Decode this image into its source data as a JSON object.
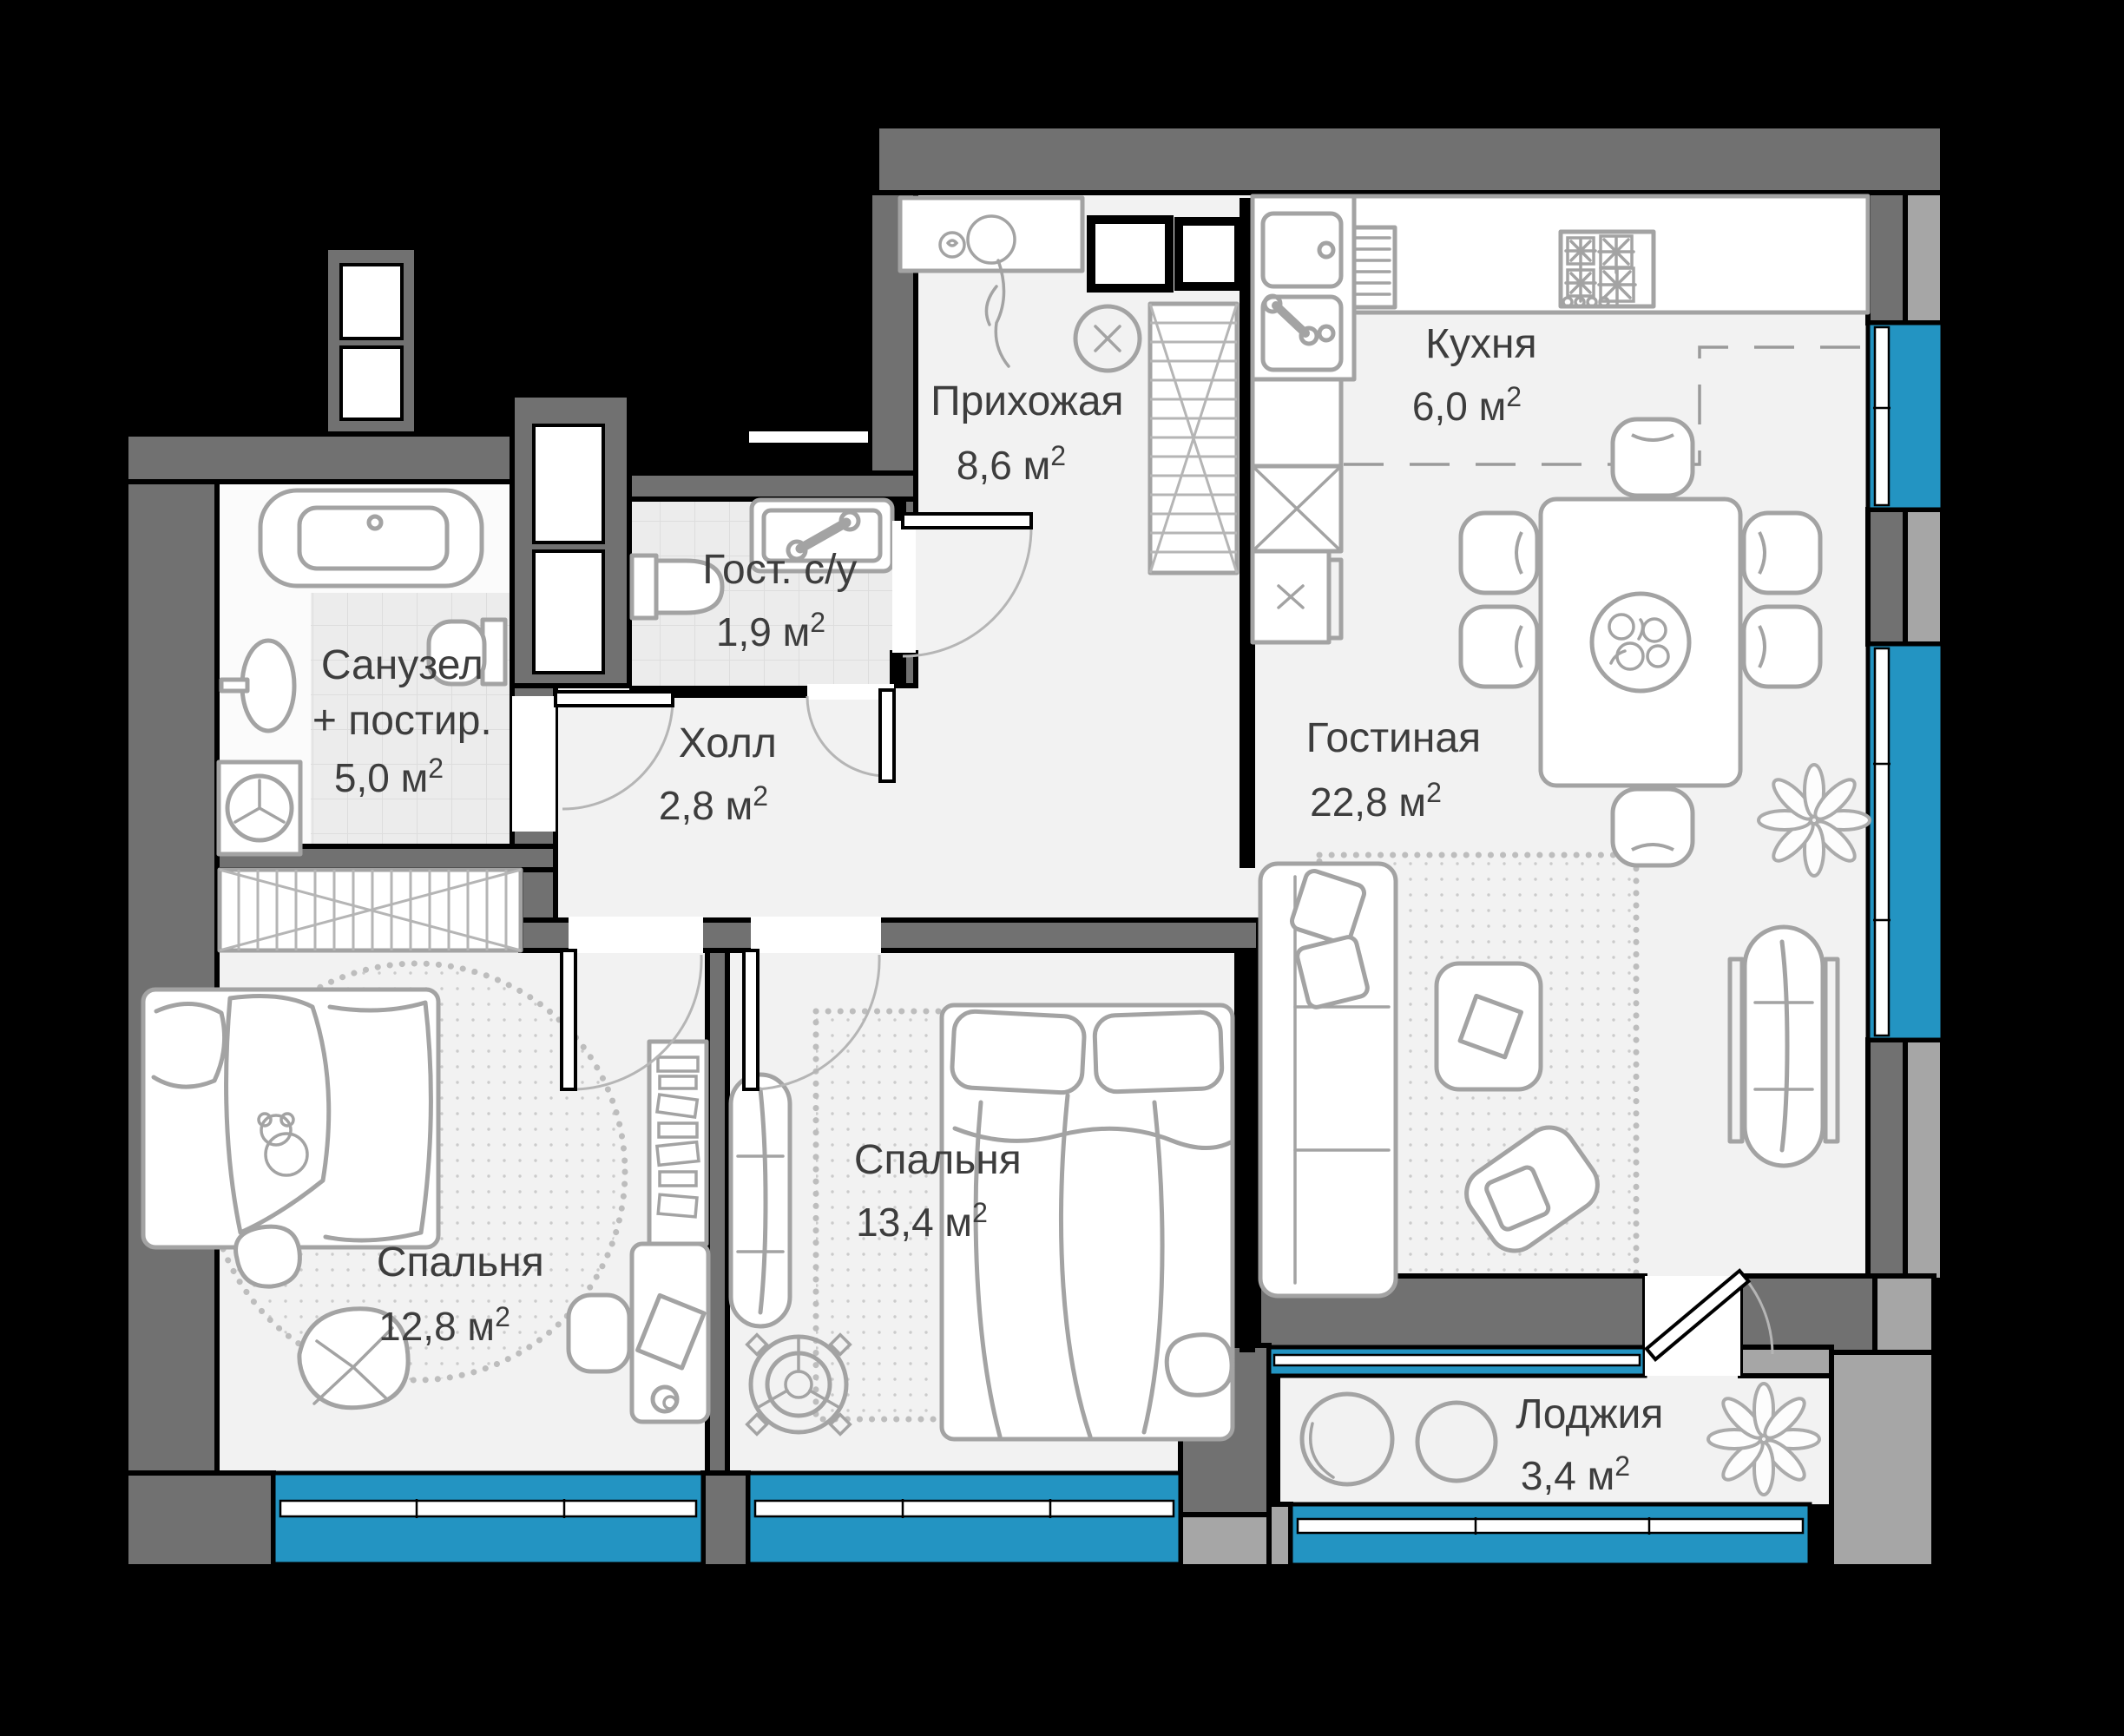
{
  "title": "Floor plan of 2-bedroom apartment",
  "labels": {
    "sup": "2"
  },
  "rooms": [
    {
      "id": "hallway",
      "name": "Прихожая",
      "area": "8,6 м"
    },
    {
      "id": "kitchen",
      "name": "Кухня",
      "area": "6,0 м"
    },
    {
      "id": "guest-wc",
      "name": "Гост. с/у",
      "area": "1,9 м"
    },
    {
      "id": "bathroom",
      "name": "Санузел",
      "name2": "+ постир.",
      "area": "5,0 м"
    },
    {
      "id": "hall",
      "name": "Холл",
      "area": "2,8 м"
    },
    {
      "id": "living-room",
      "name": "Гостиная",
      "area": "22,8 м"
    },
    {
      "id": "bedroom-middle",
      "name": "Спальня",
      "area": "13,4 м"
    },
    {
      "id": "bedroom-left",
      "name": "Спальня",
      "area": "12,8 м"
    },
    {
      "id": "loggia",
      "name": "Лоджия",
      "area": "3,4 м"
    }
  ],
  "colors": {
    "bg": "#000000",
    "wall_dark": "#717171",
    "wall_light": "#a6a6a6",
    "window_blue": "#2394c2",
    "floor": "#f2f2f2",
    "tile": "#ececec",
    "furn_stroke": "#a3a3a3",
    "text": "#3d3d3d"
  }
}
